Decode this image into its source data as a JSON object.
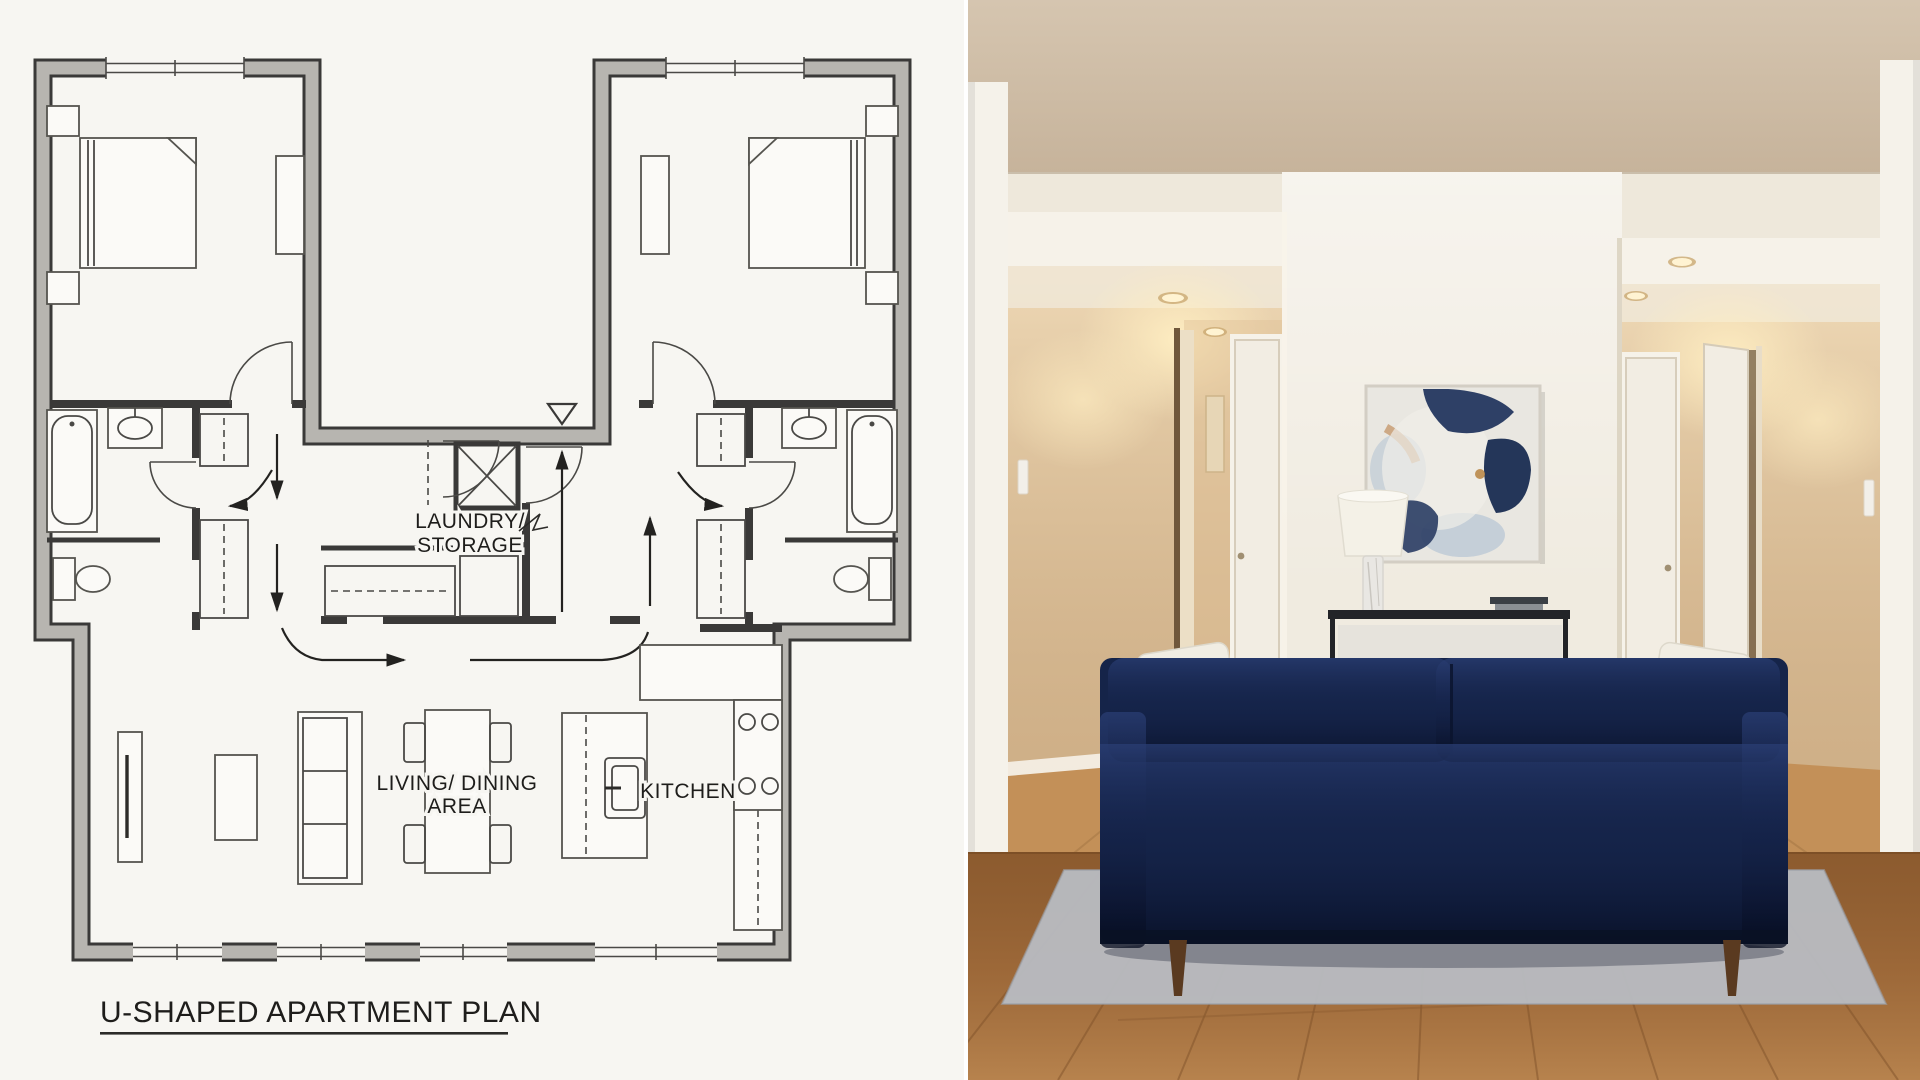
{
  "plan": {
    "title": "U-SHAPED APARTMENT PLAN",
    "labels": {
      "laundry_line1": "LAUNDRY/",
      "laundry_line2": "STORAGE",
      "living_line1": "LIVING/ DINING",
      "living_line2": "AREA",
      "kitchen": "KITCHEN"
    },
    "colors": {
      "paper": "#f7f6f2",
      "wall_gray": "#b7b5b0",
      "wall_edge": "#3a3938",
      "line_dark": "#4a4946",
      "text": "#1e1d1b"
    }
  },
  "photo": {
    "colors": {
      "ceiling_tan": "#cdbaa3",
      "upper_wall": "#eee8db",
      "center_wall": "#f0ebe0",
      "hall_wall_warm": "#e6cba4",
      "hall_glow": "#f7e3ba",
      "pillar_white": "#f5f2ea",
      "door_white": "#f2ede3",
      "trim_white": "#f6f2e9",
      "wood_floor": "#a9713e",
      "wood_hall": "#c39058",
      "plank_line": "#7b4e27",
      "rug_gray": "#b8bcc2",
      "sofa_navy": "#152449",
      "sofa_leg_brown": "#5a3a20",
      "pillow_white": "#f1ede3",
      "console_black": "#232428",
      "lamp_shade": "#f4f1e7",
      "lamp_base": "#e9e7e3",
      "art_canvas": "#e9e7e1",
      "frame_silver": "#d3cec4",
      "art_navy_1": "#2e4066",
      "art_navy_2": "#243659",
      "art_blue": "#aebfd2",
      "art_tan": "#c59a6e",
      "outlet_white": "#f2efe9",
      "book_dark": "#3a3f45",
      "book_light": "#8a8f94"
    }
  }
}
